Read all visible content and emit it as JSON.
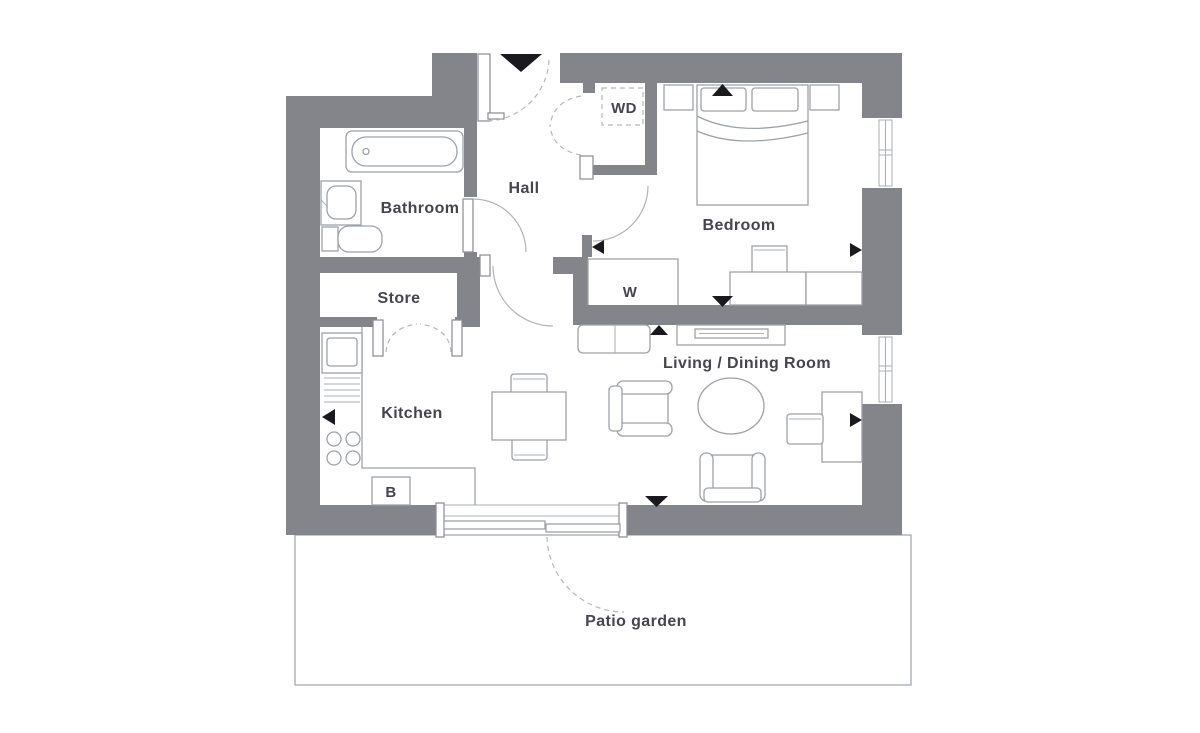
{
  "floorplan": {
    "rooms": {
      "bathroom": {
        "label": "Bathroom"
      },
      "hall": {
        "label": "Hall"
      },
      "store": {
        "label": "Store"
      },
      "kitchen": {
        "label": "Kitchen"
      },
      "bedroom": {
        "label": "Bedroom"
      },
      "living_dining": {
        "label": "Living / Dining Room"
      },
      "patio": {
        "label": "Patio garden"
      }
    },
    "closets": {
      "washer_dryer": {
        "label": "WD"
      },
      "wardrobe": {
        "label": "W"
      },
      "boiler": {
        "label": "B"
      }
    },
    "colors": {
      "wall": "#84848b",
      "furniture_line": "#9da2a8",
      "label_text": "#45464c",
      "marker": "#1a1a1e",
      "background": "#ffffff"
    }
  }
}
